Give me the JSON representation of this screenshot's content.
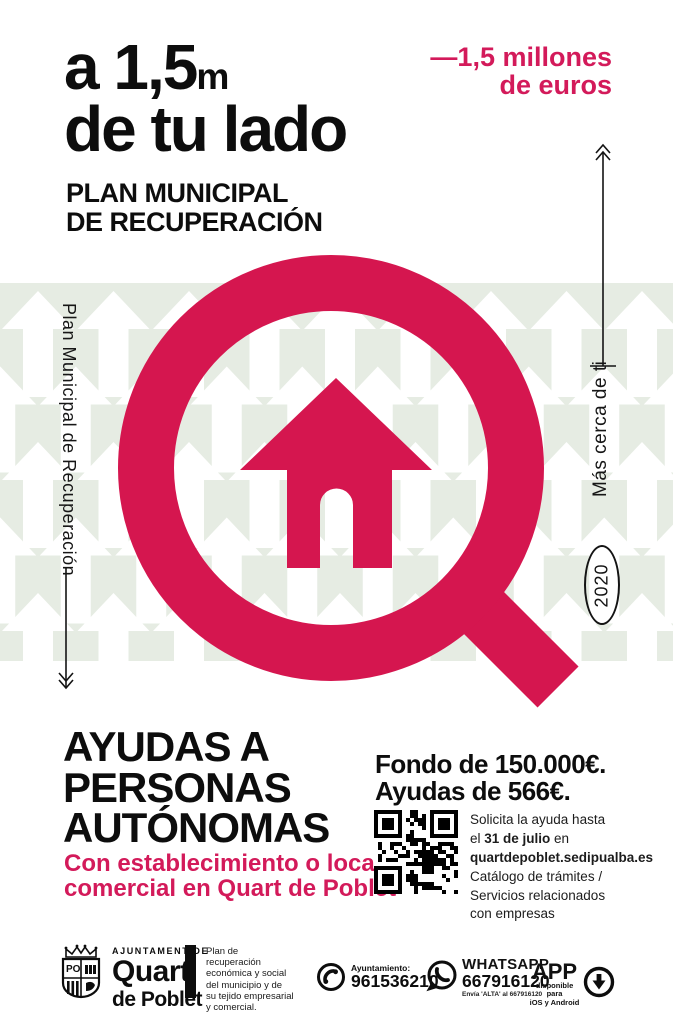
{
  "colors": {
    "accent": "#d5164f",
    "accent_text": "#d31a5a",
    "pattern_green": "#e6ece3"
  },
  "header": {
    "headline_line1_main": "a 1,5",
    "headline_line1_unit": "m",
    "headline_line2": "de tu lado",
    "plan_line1": "PLAN MUNICIPAL",
    "plan_line2": "DE RECUPERACIÓN",
    "budget_line1": "—1,5 millones",
    "budget_line2": "de euros"
  },
  "left_rail": {
    "vertical_label": "Plan Municipal de Recuperación"
  },
  "right_rail": {
    "vertical_label": "Más cerca de ti",
    "year": "2020"
  },
  "aid": {
    "title_line1": "AYUDAS A",
    "title_line2": "PERSONAS",
    "title_line3": "AUTÓNOMAS",
    "condition_line1": "Con establecimiento o local",
    "condition_line2": "comercial en Quart de Poblet",
    "fund_line1": "Fondo de 150.000€.",
    "fund_line2": "Ayudas de 566€.",
    "apply": {
      "line1": "Solicita la ayuda hasta",
      "line2_pre": "el ",
      "line2_bold": "31 de julio",
      "line2_post": " en",
      "url": "quartdepoblet.sedipualba.es",
      "line4": "Catálogo de trámites /",
      "line5": "Servicios relacionados",
      "line6": "con empresas"
    }
  },
  "footer": {
    "council_small": "AJUNTAMENT DE",
    "council_name1": "Quart",
    "council_name2": "de Poblet",
    "shield_initials": "PO",
    "plan_description": "Plan de\nrecuperación\neconómica y social\ndel municipio y de\nsu tejido empresarial\ny comercial.",
    "phone": {
      "label": "Ayuntamiento:",
      "number": "961536210"
    },
    "whatsapp": {
      "label": "WHATSAPP",
      "number": "667916120",
      "note": "Envía 'ALTA' al 667916120"
    },
    "app": {
      "label": "APP",
      "note": "disponible para\niOS y Android"
    }
  }
}
